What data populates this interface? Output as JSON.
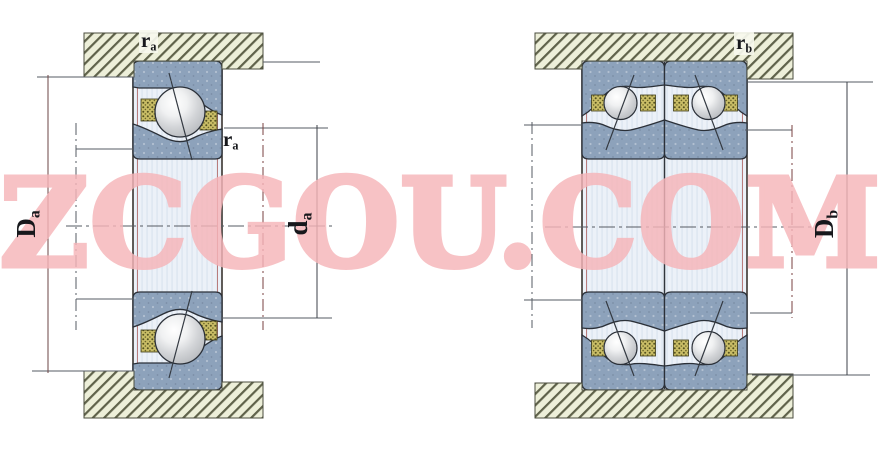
{
  "watermark": {
    "text": "ZCGOU.COM",
    "color": "#f6b5b9"
  },
  "left_figure": {
    "labels": {
      "fillet_top": {
        "base": "r",
        "sub": "a"
      },
      "fillet_side": {
        "base": "r",
        "sub": "a"
      },
      "housing_abutment_diameter": {
        "base": "D",
        "sub": "a"
      },
      "shaft_abutment_diameter": {
        "base": "d",
        "sub": "a"
      }
    }
  },
  "right_figure": {
    "labels": {
      "fillet_top": {
        "base": "r",
        "sub": "b"
      },
      "housing_abutment_diameter": {
        "base": "D",
        "sub": "b"
      }
    }
  },
  "colors": {
    "watermark_pink": "#f6b5b9",
    "ring_slate": "#8da2bb",
    "cage_khaki": "#c9bd66",
    "hatch_fill": "#edefd9",
    "hatch_line": "#5f624a",
    "shaft_light": "#ecf1f8",
    "dimension_dark": "#3c4148",
    "dimension_maroon": "#7a4040"
  }
}
